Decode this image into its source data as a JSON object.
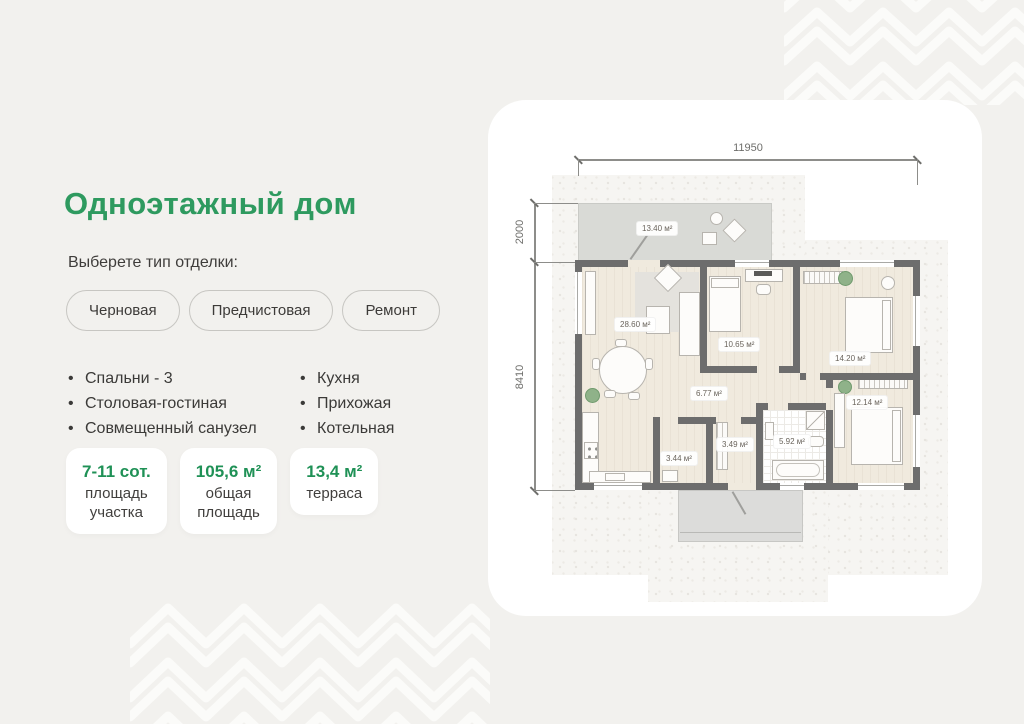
{
  "header": {
    "title": "Одноэтажный дом"
  },
  "finish": {
    "label": "Выберете тип отделки:",
    "options": [
      "Черновая",
      "Предчистовая",
      "Ремонт"
    ]
  },
  "features": {
    "col1": [
      "Спальни - 3",
      "Столовая-гостиная",
      "Совмещенный санузел"
    ],
    "col2": [
      "Кухня",
      "Прихожая",
      "Котельная"
    ]
  },
  "stats": [
    {
      "value": "7-11 сот.",
      "label": "площадь\nучастка"
    },
    {
      "value": "105,6 м²",
      "label": "общая\nплощадь"
    },
    {
      "value": "13,4 м²",
      "label": "терраса"
    }
  ],
  "plan": {
    "dim_width": "11950",
    "dim_terrace": "2000",
    "dim_house": "8410",
    "rooms": {
      "terrace": "13.40 м²",
      "living": "28.60 м²",
      "bedroom1": "10.65 м²",
      "bedroom2": "14.20 м²",
      "hall": "6.77 м²",
      "bedroom3": "12.14 м²",
      "bathroom": "5.92 м²",
      "boiler": "3.44 м²",
      "entry": "3.49 м²"
    }
  },
  "colors": {
    "accent": "#2e9a5f"
  }
}
